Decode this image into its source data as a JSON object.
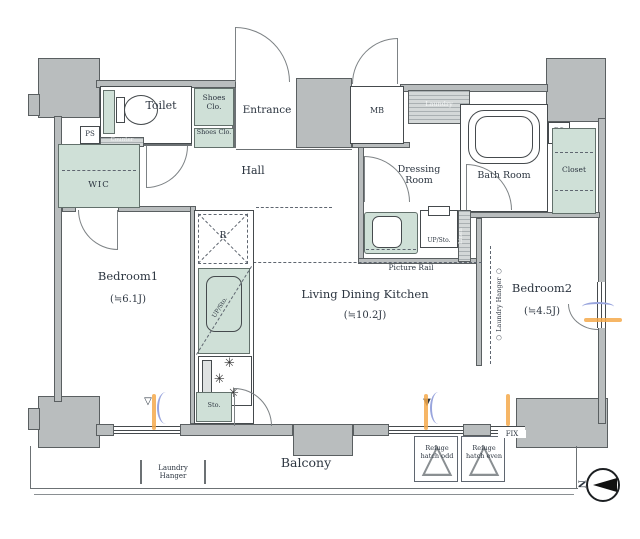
{
  "title": "Apartment floor plan",
  "colors": {
    "wall_gray": "#b9bdbe",
    "fixture_green": "#cfe0d7",
    "accent_orange": "#f4a94b",
    "accent_blue": "#99a5dd",
    "text": "#2c3540"
  },
  "rooms": {
    "bedroom1": {
      "name": "Bedroom1",
      "size": "(≒6.1J)"
    },
    "bedroom2": {
      "name": "Bedroom2",
      "size": "(≒4.5J)"
    },
    "ldk": {
      "name": "Living Dining Kitchen",
      "size": "(≒10.2J)"
    },
    "toilet": {
      "name": "Toilet"
    },
    "entrance": {
      "name": "Entrance"
    },
    "hall": {
      "name": "Hall"
    },
    "wic": {
      "name": "WIC"
    },
    "dressing_room": {
      "name": "Dressing Room"
    },
    "bath_room": {
      "name": "Bath Room"
    },
    "closet": {
      "name": "Closet"
    },
    "balcony": {
      "name": "Balcony"
    }
  },
  "features": {
    "ps": "PS",
    "mb": "MB",
    "shoes_closet": "Shoes Clo.",
    "refrigerator": "R",
    "storage": "Sto.",
    "upper_storage": "UP/Sto.",
    "counter": "Counter",
    "laundry": "Laundry",
    "linen": "Linen",
    "picture_rail": "Picture Rail",
    "laundry_hanger": "Laundry Hanger",
    "laundry_hanger_vertical": "○ Laundry Hanger ○",
    "refuge_hatch_odd": "Refuge hatch odd",
    "refuge_hatch_even": "Refuge hatch even",
    "fix_window": "FIX",
    "north": "N"
  }
}
